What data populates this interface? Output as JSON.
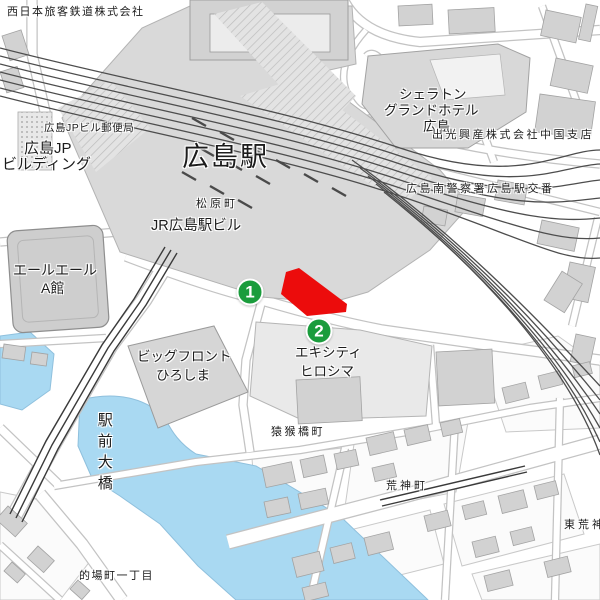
{
  "map": {
    "kind": "street-map",
    "labels": [
      {
        "id": "west-jr-company",
        "text": "西日本旅客鉄道株式会社",
        "x": 7,
        "y": 7,
        "size": 11,
        "ls": 1.5
      },
      {
        "id": "jp-post-office",
        "text": "広島JPビル郵便局",
        "x": 44,
        "y": 123,
        "size": 10.5,
        "ls": 0.5
      },
      {
        "id": "jp-building-line1",
        "text": "広島JP",
        "x": 24,
        "y": 141,
        "size": 15,
        "ls": 0
      },
      {
        "id": "jp-building-line2",
        "text": "ビルディング",
        "x": 2,
        "y": 157,
        "size": 15,
        "ls": 0
      },
      {
        "id": "hiroshima-station",
        "text": "広島駅",
        "x": 182,
        "y": 143,
        "size": 27,
        "ls": 2
      },
      {
        "id": "matsubara-cho",
        "text": "松原町",
        "x": 196,
        "y": 199,
        "size": 11,
        "ls": 3
      },
      {
        "id": "jr-hiroshima-station-bldg",
        "text": "JR広島駅ビル",
        "x": 151,
        "y": 219,
        "size": 14.5,
        "ls": 0
      },
      {
        "id": "sheraton-line1",
        "text": "シェラトン",
        "x": 399,
        "y": 88,
        "size": 13.5,
        "ls": 0
      },
      {
        "id": "sheraton-line2",
        "text": "グランドホテル",
        "x": 384,
        "y": 104,
        "size": 13.5,
        "ls": 0
      },
      {
        "id": "sheraton-line3",
        "text": "広島",
        "x": 423,
        "y": 120,
        "size": 13.5,
        "ls": 0
      },
      {
        "id": "idemitsu-chugoku-branch",
        "text": "出光興産株式会社中国支店",
        "x": 432,
        "y": 130,
        "size": 11,
        "ls": 2.5
      },
      {
        "id": "police-box",
        "text": "広島南警察署広島駅交番",
        "x": 406,
        "y": 184,
        "size": 11,
        "ls": 2.5
      },
      {
        "id": "yale-yale-line1",
        "text": "エールエール",
        "x": 13,
        "y": 263,
        "size": 14,
        "ls": 0
      },
      {
        "id": "yale-yale-line2",
        "text": "A館",
        "x": 41,
        "y": 281,
        "size": 14,
        "ls": 0
      },
      {
        "id": "big-front-line1",
        "text": "ビッグフロント",
        "x": 137,
        "y": 350,
        "size": 13.5,
        "ls": 0
      },
      {
        "id": "big-front-line2",
        "text": "ひろしま",
        "x": 156,
        "y": 369,
        "size": 13.5,
        "ls": 0
      },
      {
        "id": "ekicity-line1",
        "text": "エキシティ",
        "x": 295,
        "y": 346,
        "size": 13.5,
        "ls": 0
      },
      {
        "id": "ekicity-line2",
        "text": "ヒロシマ",
        "x": 300,
        "y": 365,
        "size": 13.5,
        "ls": 0
      },
      {
        "id": "ekimae-ohashi-bridge",
        "text": "駅前大橋",
        "x": 96,
        "y": 412,
        "size": 15,
        "ls": 6,
        "dir": "v"
      },
      {
        "id": "enkobashi-cho",
        "text": "猿猴橋町",
        "x": 271,
        "y": 427,
        "size": 11,
        "ls": 2.5
      },
      {
        "id": "kojin-machi",
        "text": "荒神町",
        "x": 386,
        "y": 481,
        "size": 11,
        "ls": 3
      },
      {
        "id": "matoba-cho-1",
        "text": "的場町一丁目",
        "x": 79,
        "y": 571,
        "size": 11,
        "ls": 1.5
      },
      {
        "id": "higashi-kojin-machi",
        "text": "東荒神町",
        "x": 564,
        "y": 520,
        "size": 11,
        "ls": 3
      }
    ],
    "markers": [
      {
        "number": "1",
        "x": 250,
        "y": 292
      },
      {
        "number": "2",
        "x": 319,
        "y": 331
      }
    ],
    "highlight": {
      "name": "selected-building",
      "shape": "polygon"
    },
    "colors": {
      "marker_green": "#1a9c3c",
      "highlight_red": "#ec0c0c",
      "water_blue": "#a9d9f2",
      "station_gray": "#d9d9d9",
      "rail_dark": "#4d4d4d"
    }
  }
}
